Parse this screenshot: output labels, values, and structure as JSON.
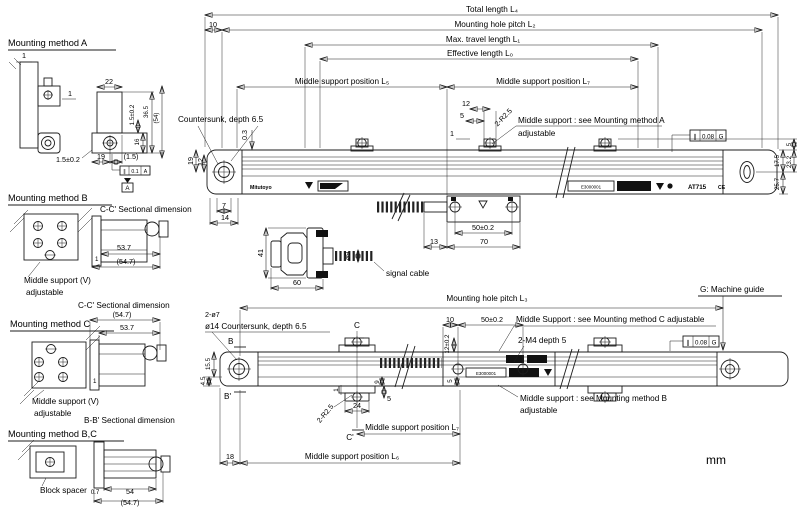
{
  "units_label": "mm",
  "scale_face": {
    "brand": "Mitutoyo",
    "serial": "E3000001",
    "model": "AT715",
    "ce": "CE"
  },
  "frames": {
    "a": {
      "sym": "∥",
      "val": "0.1",
      "datum": "A",
      "datum_box": "A"
    },
    "g_top": {
      "sym": "∥",
      "val": "0.08",
      "datum": "G"
    },
    "g_bot": {
      "sym": "∥",
      "val": "0.08",
      "datum": "G"
    }
  },
  "top_view": {
    "total_length": "Total length L₄",
    "hole_pitch": "Mounting hole pitch L₂",
    "d10": "10",
    "max_travel": "Max. travel length L₁",
    "effective_length": "Effective length L₀",
    "support_l5": "Middle support position L₅",
    "support_l7": "Middle support position L₇",
    "countersunk_note": "Countersunk, depth 6.5",
    "support_note_line1": "Middle support : see Mounting method A",
    "support_note_line2": "adjustable",
    "r25": "2-R2.5",
    "d12": "12",
    "d5": "5",
    "d1": "1",
    "d03": "0.3",
    "hole_d19": "19",
    "hole_d12": "12",
    "end_d7": "7",
    "end_d14": "14",
    "right_d5": "5",
    "right_d232": "23.2",
    "right_d175": "17.5",
    "right_d257": "25.7",
    "head_d50": "50±0.2",
    "head_d70": "70",
    "head_d13": "13",
    "cable_dia": "ø9",
    "conn_d41": "41",
    "conn_d60": "60",
    "signal_cable": "signal cable"
  },
  "bottom_view": {
    "hole_pitch": "Mounting hole pitch L₃",
    "machine_guide": "G: Machine guide",
    "support_c_note": "Middle Support : see Mounting method C adjustable",
    "m4_note": "2-M4 depth 5",
    "support_b_note_line1": "Middle support : see Mounting method B",
    "support_b_note_line2": "adjustable",
    "d10": "10",
    "d50": "50±0.2",
    "d12": "12±0.2",
    "d5": "5",
    "holes_note1": "2-ø7",
    "holes_note2": "ø14 Countersunk, depth 6.5",
    "sec_b": "B",
    "sec_b2": "B'",
    "sec_c": "C",
    "sec_c2": "C'",
    "d155": "15.5",
    "d45": "4.5",
    "r25": "2-R2.5",
    "d1": "1",
    "d9": "9",
    "d5b": "5",
    "d24": "24",
    "support_l7": "Middle support position L₇",
    "support_l6": "Middle support position L₆",
    "d18": "18"
  },
  "method_a": {
    "title": "Mounting method A",
    "d1_top": "1",
    "d1_side": "1",
    "d22": "22",
    "d15a": "1.5±0.2",
    "d365": "36.5",
    "d54": "(54)",
    "d16": "16",
    "d19": "19",
    "d15p": "(1.5)",
    "d15b": "1.5±0.2"
  },
  "method_b": {
    "title": "Mounting method B",
    "section_title": "C-C' Sectional dimension",
    "d537": "53.7",
    "d547": "(54.7)",
    "d1": "1",
    "support_v": "Middle support (V)",
    "adjustable": "adjustable"
  },
  "method_c": {
    "title": "Mounting method C",
    "section_title": "C-C' Sectional dimension",
    "d547": "(54.7)",
    "d537": "53.7",
    "d1": "1",
    "support_v": "Middle support (V)",
    "adjustable": "adjustable"
  },
  "method_bc": {
    "title": "Mounting method B,C",
    "section_title": "B-B' Sectional dimension",
    "block_spacer": "Block spacer",
    "d07": "0.7",
    "d54": "54",
    "d547": "(54.7)"
  }
}
